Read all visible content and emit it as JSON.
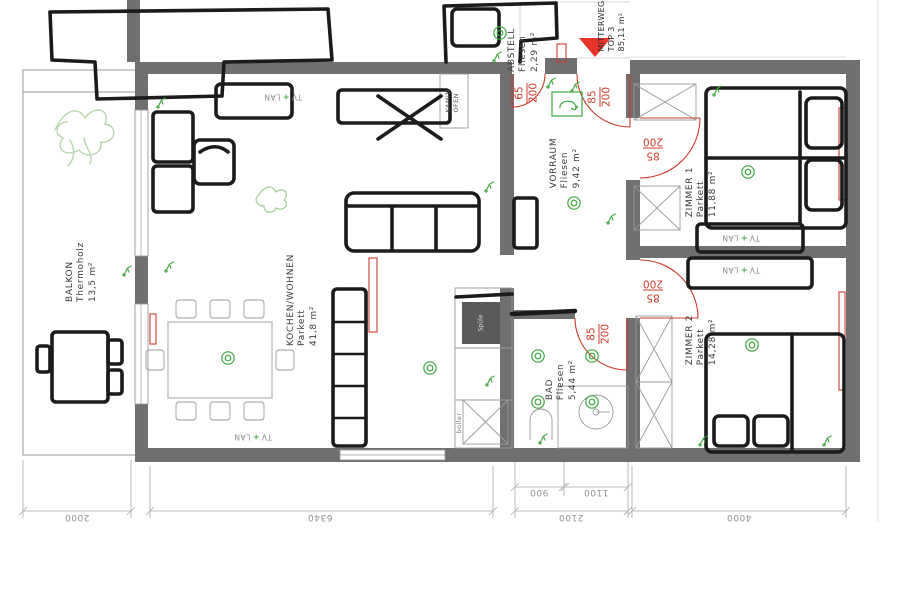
{
  "plan": {
    "street": "MITTERWEG",
    "unit": "TOP 3",
    "total_area": "85,11 m²"
  },
  "rooms": {
    "balkon": {
      "name": "BALKON",
      "material": "Thermoholz",
      "area": "13,5 m²"
    },
    "kochen_wohnen": {
      "name": "KOCHEN/WOHNEN",
      "material": "Parkett",
      "area": "41,8 m²"
    },
    "vorraum": {
      "name": "VORRAUM",
      "material": "Fliesen",
      "area": "9,42 m²"
    },
    "abstell": {
      "name": "ABSTELL",
      "material": "Fliesen",
      "area": "2,29 m²"
    },
    "zimmer1": {
      "name": "ZIMMER 1",
      "material": "Parkett",
      "area": "11,88 m²"
    },
    "zimmer2": {
      "name": "ZIMMER 2",
      "material": "Parkett",
      "area": "14,28 m²"
    },
    "bad": {
      "name": "BAD",
      "material": "Fliesen",
      "area": "5,44 m²"
    }
  },
  "doors": {
    "abstell": {
      "width": "65",
      "height": "200"
    },
    "entrance": {
      "width": "85",
      "height": "200"
    },
    "zimmer1": {
      "width": "85",
      "height": "200"
    },
    "zimmer2": {
      "width": "85",
      "height": "200"
    },
    "bad": {
      "width": "85",
      "height": "200"
    }
  },
  "labels": {
    "kamin": "KAMIN",
    "ofen": "OFEN",
    "boiler": "boiler",
    "sink": "Spüle",
    "tv": "TV",
    "lan": "LAN"
  },
  "dimensions": {
    "balkon_width": "2000",
    "living_width": "6340",
    "bad_left": "900",
    "bad_right": "1100",
    "bad_total": "2100",
    "zimmer_width": "4000"
  },
  "colors": {
    "wall_grey": "#6f6f6f",
    "door_red": "#cf3b2a",
    "entrance_arrow_red": "#e8332a",
    "electric_green": "#3aa83a",
    "dimension_grey": "#9a9a9a",
    "sketch_black": "#1b1b1b",
    "plant_green": "#b8d6ab"
  }
}
